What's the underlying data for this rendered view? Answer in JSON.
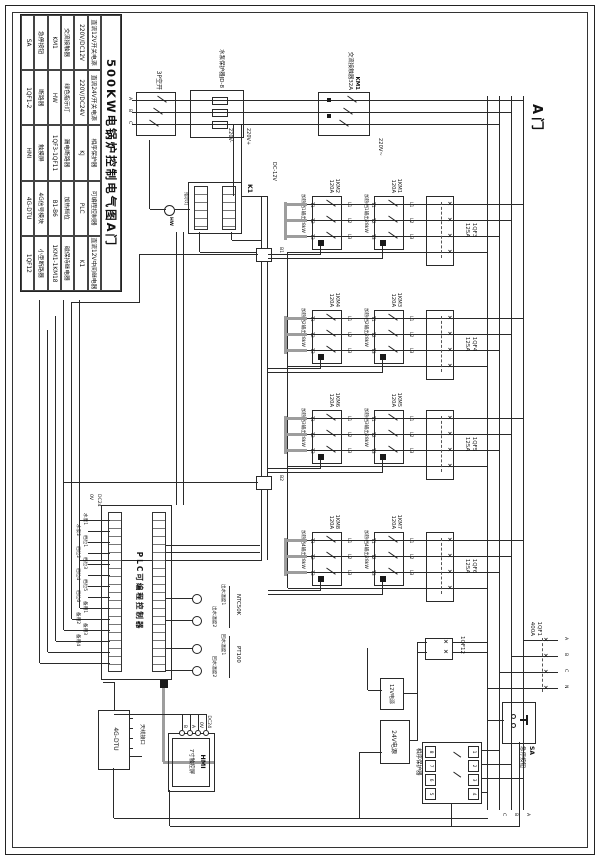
{
  "sheet": {
    "door_label": "A门"
  },
  "legend": {
    "title": "500KW电锅炉控制电气图A门",
    "cells": [
      "直流12V开关电源",
      "直流24V开关电源",
      "相序保护器",
      "可编程控制器",
      "直流12V中间继电器",
      "220V/DC12V",
      "220V/DC24V",
      "KJ",
      "PLC",
      "K1",
      "交流接触器",
      "绿色指示灯",
      "漏电断路器",
      "加热档位",
      "磁保持继电器",
      "KM1",
      "HW",
      "1QF3-1QF11",
      "B1-B6",
      "1KM1-1KM18",
      "急停按钮",
      "断路器",
      "触摸屏",
      "4G信号模块",
      "小型断路器",
      "SA",
      "1QF1-2",
      "HMI",
      "4G-DTU",
      "1QF12"
    ]
  },
  "pump": {
    "breaker": "3P空开",
    "protector": "水泵保护器JD-8",
    "km": "KM1",
    "km_rating": "交流接触器32A",
    "volt": "220V~",
    "phases": [
      "A",
      "B",
      "C"
    ]
  },
  "ctrl": {
    "k1": "K1",
    "hw": "HW",
    "lamp": "指示灯",
    "v_plus": "220V+",
    "v_minus": "220V-",
    "dc12": "DC-12V",
    "b1": "B1",
    "b2": "B2"
  },
  "term": {
    "l": [
      "L1",
      "L2",
      "L3"
    ],
    "t": [
      "T1",
      "T2",
      "T3"
    ]
  },
  "groups": [
    {
      "qf": "1QF3",
      "qf_rating": "125A",
      "km_top": "1KM1",
      "km_bot": "1KM2",
      "rating": "120A",
      "out": "加热档1输出28kW"
    },
    {
      "qf": "1QF4",
      "qf_rating": "125A",
      "km_top": "1KM3",
      "km_bot": "1KM4",
      "rating": "120A",
      "out": "加热档2输出28kW"
    },
    {
      "qf": "1QF5",
      "qf_rating": "125A",
      "km_top": "1KM5",
      "km_bot": "1KM6",
      "rating": "120A",
      "out": "加热档3输出28kW"
    },
    {
      "qf": "1QF6",
      "qf_rating": "125A",
      "km_top": "1KM7",
      "km_bot": "1KM8",
      "rating": "120A",
      "out": "加热档4输出28kW"
    }
  ],
  "mains": {
    "qf1": "1QF1",
    "qf1_rating": "400A",
    "ph": [
      "A",
      "B",
      "C",
      "N"
    ],
    "bus_labels": [
      "A",
      "B",
      "C"
    ],
    "sa": "SA",
    "sa_label": "急停按钮",
    "kj_label": "相序保护器",
    "pp_top": [
      "1",
      "2",
      "3",
      "4"
    ],
    "pp_bot": [
      "8",
      "7",
      "6",
      "5"
    ]
  },
  "power": {
    "qf12": "1QF12",
    "ps12": "12V电源",
    "ps24": "24V电源"
  },
  "plc": {
    "title": "PLC可编程控制器",
    "dc24": "DC24",
    "v0": "0V",
    "outputs": [
      "水泵1",
      "水泵2",
      "档位1",
      "档位2",
      "档位3",
      "档位4",
      "档位5",
      "档位6",
      "备用1",
      "备用2",
      "备用3",
      "备用4"
    ],
    "ntc": "NTC50K",
    "pt": "PT100",
    "probes": [
      "出水温度1",
      "出水温度2",
      "回水温度1",
      "回水温度2"
    ]
  },
  "comm": {
    "hmi": "HMI",
    "hmi_sub": "7寸触控屏",
    "hmi_terms": [
      "DC24",
      "0V",
      "A",
      "B"
    ],
    "dtu": "4G-DTU",
    "antenna": "天线接口"
  }
}
